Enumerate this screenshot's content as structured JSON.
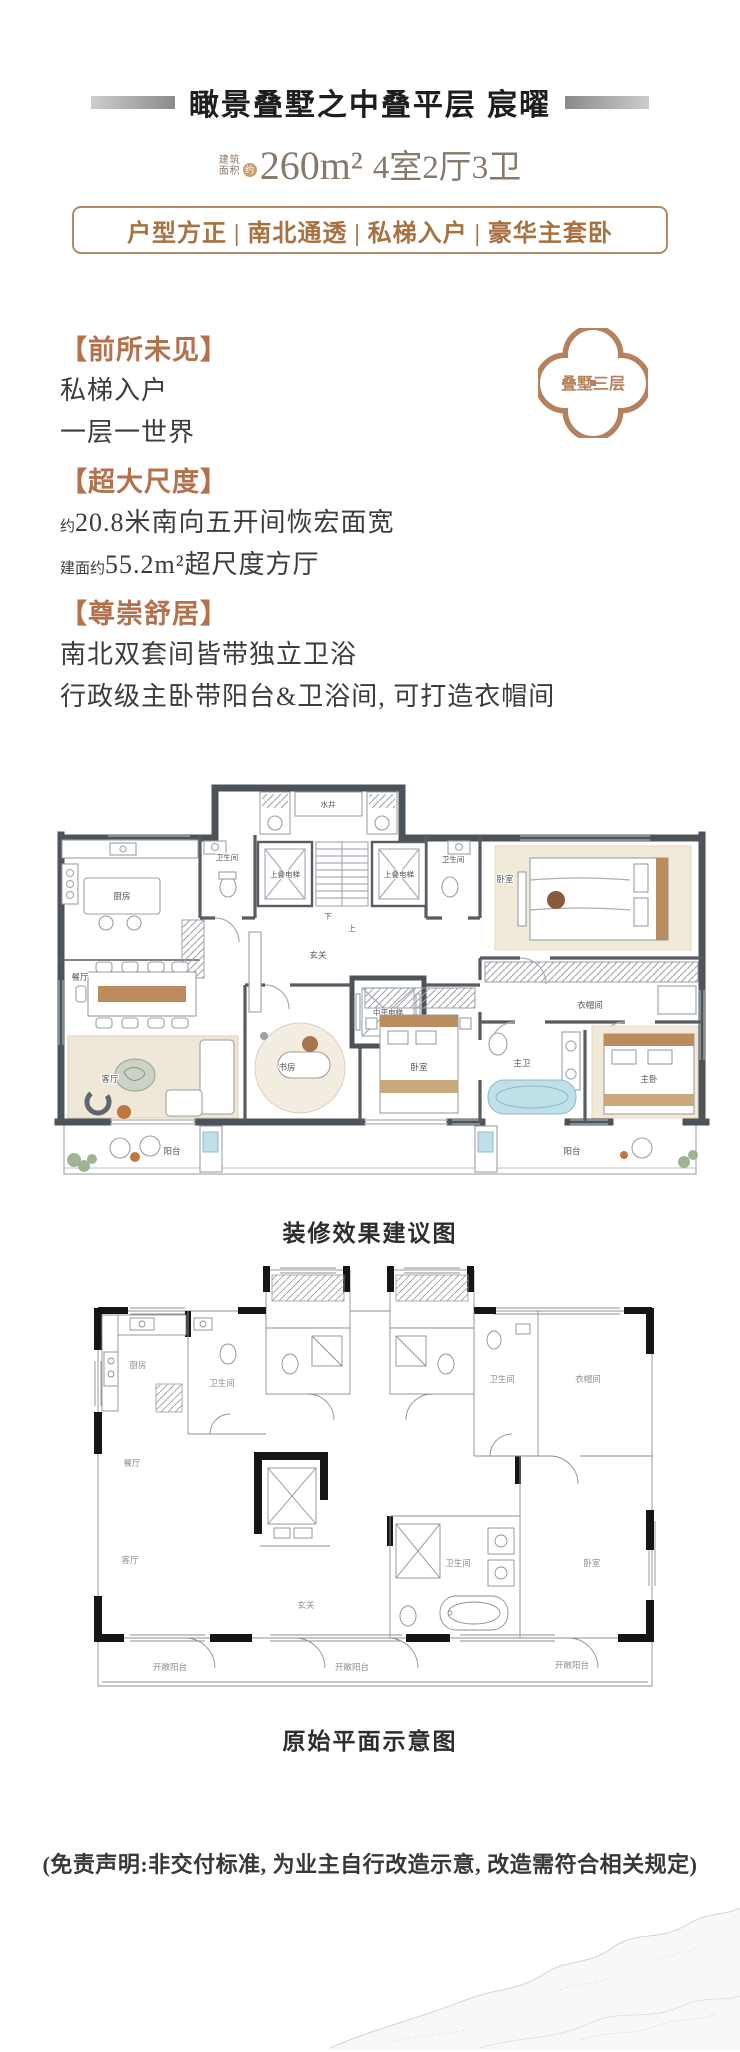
{
  "header": {
    "title": "瞰景叠墅之中叠平层 宸曜",
    "area_label_top": "建筑",
    "area_label_bottom": "面积",
    "area_approx": "约",
    "area_value": "260m²",
    "rooms_value": "4室2厅3卫",
    "features": "户型方正 | 南北通透 | 私梯入户 | 豪华主套卧"
  },
  "badge": {
    "label": "叠墅三层"
  },
  "sections": [
    {
      "title": "【前所未见】",
      "lines": [
        {
          "prefix": "",
          "text": "私梯入户"
        },
        {
          "prefix": "",
          "text": "一层一世界"
        }
      ]
    },
    {
      "title": "【超大尺度】",
      "lines": [
        {
          "prefix": "约",
          "text": "20.8米南向五开间恢宏面宽"
        },
        {
          "prefix": "建面约",
          "text": "55.2m²超尺度方厅"
        }
      ]
    },
    {
      "title": "【尊崇舒居】",
      "lines": [
        {
          "prefix": "",
          "text": "南北双套间皆带独立卫浴"
        },
        {
          "prefix": "",
          "text": "行政级主卧带阳台&卫浴间, 可打造衣帽间"
        }
      ]
    }
  ],
  "plans": {
    "decorated": {
      "caption": "装修效果建议图",
      "rooms": {
        "kitchen": "厨房",
        "bath_left": "卫生间",
        "bath_right": "卫生间",
        "water_well": "水井",
        "elevator_left": "上叠电梯",
        "elevator_right": "上叠电梯",
        "stair_down": "下",
        "stair_up": "上",
        "foyer": "玄关",
        "mid_elevator": "中平电梯",
        "bedroom_north": "卧室",
        "cloakroom": "衣帽间",
        "dining": "餐厅",
        "living": "客厅",
        "study": "书房",
        "bedroom_south": "卧室",
        "master_bath": "主卫",
        "master_bedroom": "主卧",
        "balcony_left": "阳台",
        "balcony_right": "阳台"
      }
    },
    "original": {
      "caption": "原始平面示意图",
      "rooms": {
        "kitchen": "厨房",
        "bath_a": "卫生间",
        "bath_b": "卫生间",
        "bath_c": "卫生间",
        "dining": "餐厅",
        "living": "客厅",
        "foyer": "玄关",
        "cloakroom": "衣帽间",
        "bedroom": "卧室",
        "terrace_left": "开敞阳台",
        "terrace_center": "开敞阳台",
        "terrace_right": "开敞阳台"
      }
    }
  },
  "disclaimer": "(免责声明:非交付标准, 为业主自行改造示意, 改造需符合相关规定)",
  "colors": {
    "accent_bronze": "#b4714b",
    "feature_text": "#a8713f",
    "feature_border": "#b18a66",
    "spec_text": "#87796b",
    "title_text": "#1e1e1e",
    "badge": "#b5825f",
    "wall": "#4d5358",
    "plan_black": "#151515",
    "wood": "#bb8c5e",
    "teal": "#bfe0e8",
    "rug": "#efe7d8"
  }
}
